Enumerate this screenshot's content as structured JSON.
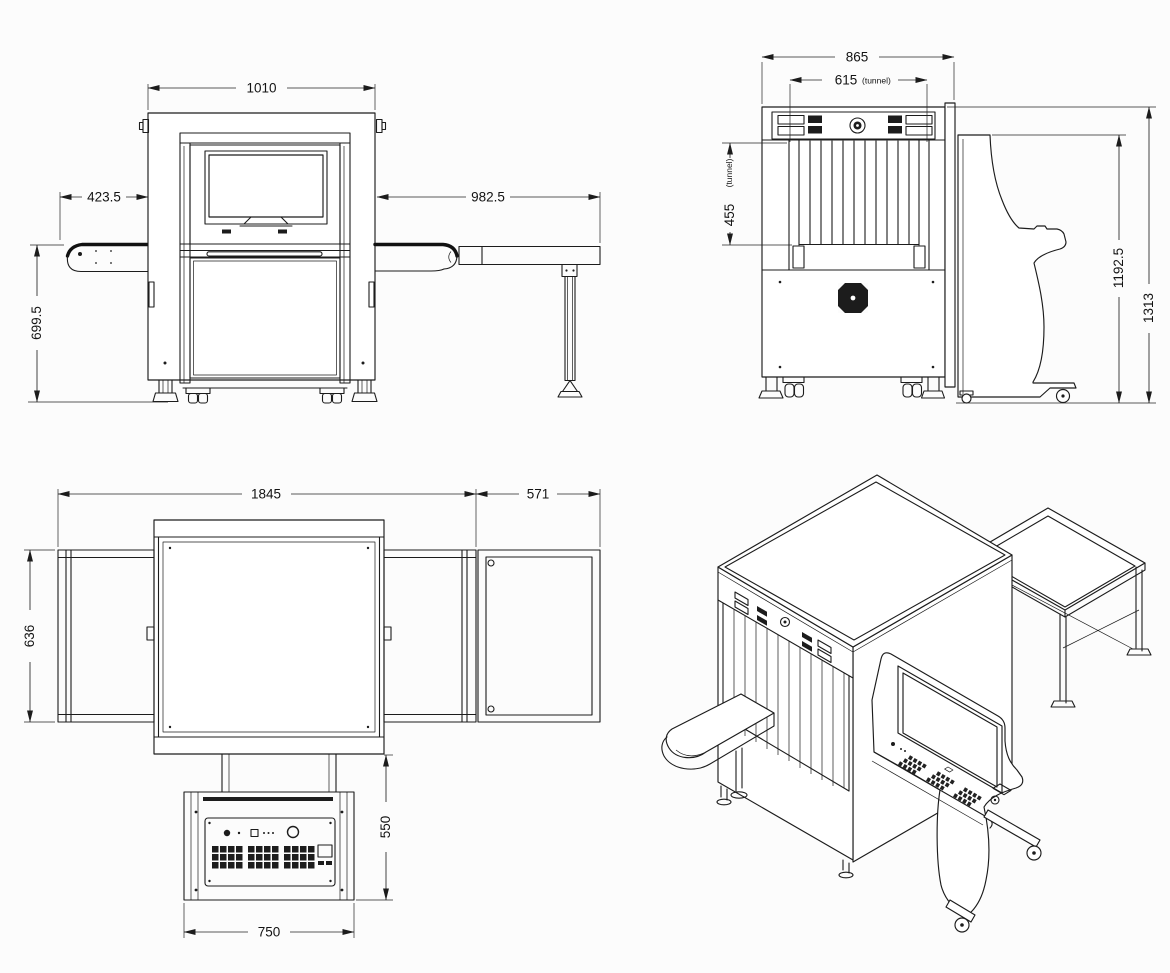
{
  "document": {
    "type": "technical dimensional drawing",
    "subject": "x-ray baggage scanner with operator console and roller table",
    "ink_color": "#1c1c1c",
    "background_color": "#fcfcfc"
  },
  "views": {
    "front": {
      "name": "front elevation",
      "dims": {
        "overall_width": "1010",
        "infeed_length": "423.5",
        "outfeed_length": "982.5",
        "belt_height": "699.5"
      }
    },
    "end": {
      "name": "end elevation with console profile",
      "dims": {
        "overall_width": "865",
        "tunnel_width": "615",
        "tunnel_width_note": "(tunnel)",
        "tunnel_height": "455",
        "tunnel_height_note": "(tunnel)",
        "console_height": "1192.5",
        "overall_height": "1313"
      }
    },
    "plan": {
      "name": "plan view",
      "dims": {
        "overall_length": "1845",
        "roller_table_length": "571",
        "conveyor_width": "636",
        "console_depth": "550",
        "console_width": "750"
      }
    },
    "isometric": {
      "name": "isometric view"
    }
  }
}
